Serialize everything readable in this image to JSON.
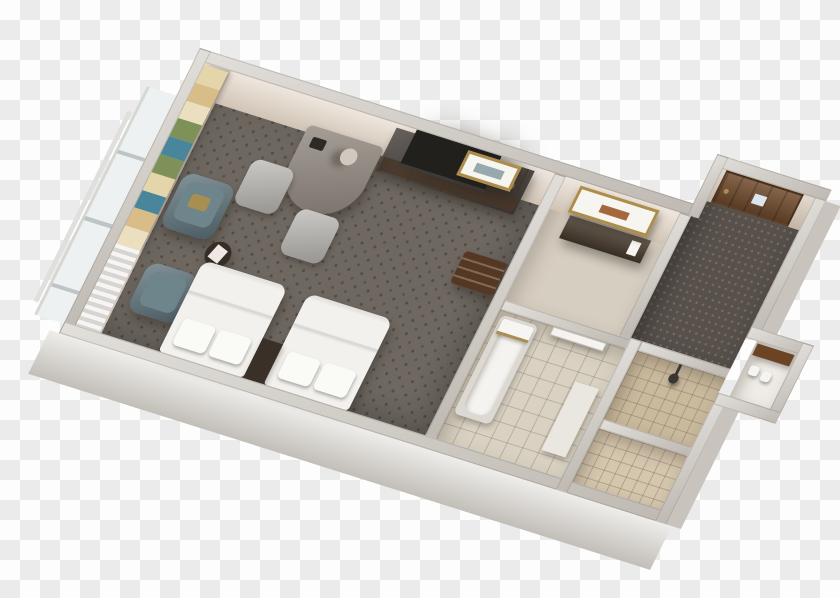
{
  "image": {
    "description": "Photorealistic 3D isometric floor plan render of a hotel guest room with two double beds, work desk, TV credenza, armchair corner, entry hall and bathroom with tub, walk-in shower and closet, displayed over a transparency checkerboard background",
    "view": "dollhouse top-down, rotated about 20 degrees clockwise",
    "background_type": "transparency checkerboard"
  },
  "background": {
    "checker_light": "#fdfdfd",
    "checker_dark": "#ebebeb",
    "square_px": 20
  },
  "colors": {
    "wall_top": "#cfcbc4",
    "wall_face": "#e7dccf",
    "wall_face_dark": "#d6c9ba",
    "wall_outer": "#dfdcd7",
    "wall_outer_dark": "#c8c4bd",
    "carpet": "#6e6861",
    "entry_carpet": "#57504b",
    "vanity_floor": "#d6cec1",
    "tile": "#d9d2c3",
    "tile_shower": "#c9b99d",
    "tile_nook": "#d5c6ae",
    "closet_floor": "#efece7",
    "bed": "#f2f1ee",
    "pillow": "#fafaf7",
    "nightstand": "#3b3028",
    "desk_top": "#8d847b",
    "furniture_dark": "#4b4540",
    "drawer_brown": "#4a382a",
    "tv": "#22201d",
    "lamp": "#cfc9bf",
    "phone": "#2e2a26",
    "chair_gray": "#b7b4af",
    "armchair": "#5f747c",
    "armchair_cushion": "#6e858c",
    "accent_gold": "#a98e52",
    "table_dark": "#352e27",
    "magazine": "#f1e7e4",
    "luggage_rack": "#543823",
    "door_brown": "#6f4a2c",
    "door_sign": "#dde6ee",
    "door_white": "#f4f3f0",
    "frame_gold": "#ad8d4a",
    "art_mat": "#f7f5f0",
    "art_landscape": "#97a9ac",
    "mirror_art": "#a5683c",
    "vanity_dark": "#46392b",
    "tub_rim": "#dcd9d3",
    "tub": "#f4f3f0",
    "towel": "#f6f5f2",
    "counter_white": "#eae7e1",
    "shower_fixture": "#3a3632",
    "shelf_brown": "#6b4423",
    "closet_item": "#f6f4f1",
    "glass": "#eef1f2",
    "rail": "#dfdfdc"
  },
  "curtain": {
    "s1": "#e4d6aa",
    "s2": "#d8bd88",
    "s3": "#ecdfc0",
    "s4": "#7e9158",
    "s5": "#4a869b",
    "s6": "#7e9158",
    "s7": "#e4d6aa",
    "s8": "#4a869b",
    "s9": "#d8bd88",
    "s10": "#ecdfc0",
    "sheer": "#ecebe7"
  },
  "rooms": [
    {
      "name": "bedroom",
      "floor": "dark patterned carpet"
    },
    {
      "name": "entry-hall",
      "floor": "dark dotted carpet"
    },
    {
      "name": "vanity-area",
      "floor": "light carpet"
    },
    {
      "name": "bathroom",
      "floor": "beige tile"
    },
    {
      "name": "shower",
      "floor": "tan tile"
    },
    {
      "name": "linen-nook",
      "floor": "tan tile"
    },
    {
      "name": "closet",
      "floor": "white"
    }
  ],
  "furniture": [
    "double bed x2 with white linens and pillows",
    "dark nightstand between beds",
    "work desk with lamp and telephone",
    "gray office chair x2",
    "flat-screen TV on dark credenza with drawers",
    "gold-framed landscape art",
    "teal armchair x2 with gold pillow",
    "round dark side table with magazine",
    "striped floor-to-ceiling curtains with sheer panel",
    "wooden luggage rack",
    "brown entry door with room-number sign",
    "gold-framed mirror over dark vanity",
    "bathtub with towels",
    "white bathroom door",
    "walk-in shower with fixture",
    "closet with wooden shelf and amenities"
  ]
}
